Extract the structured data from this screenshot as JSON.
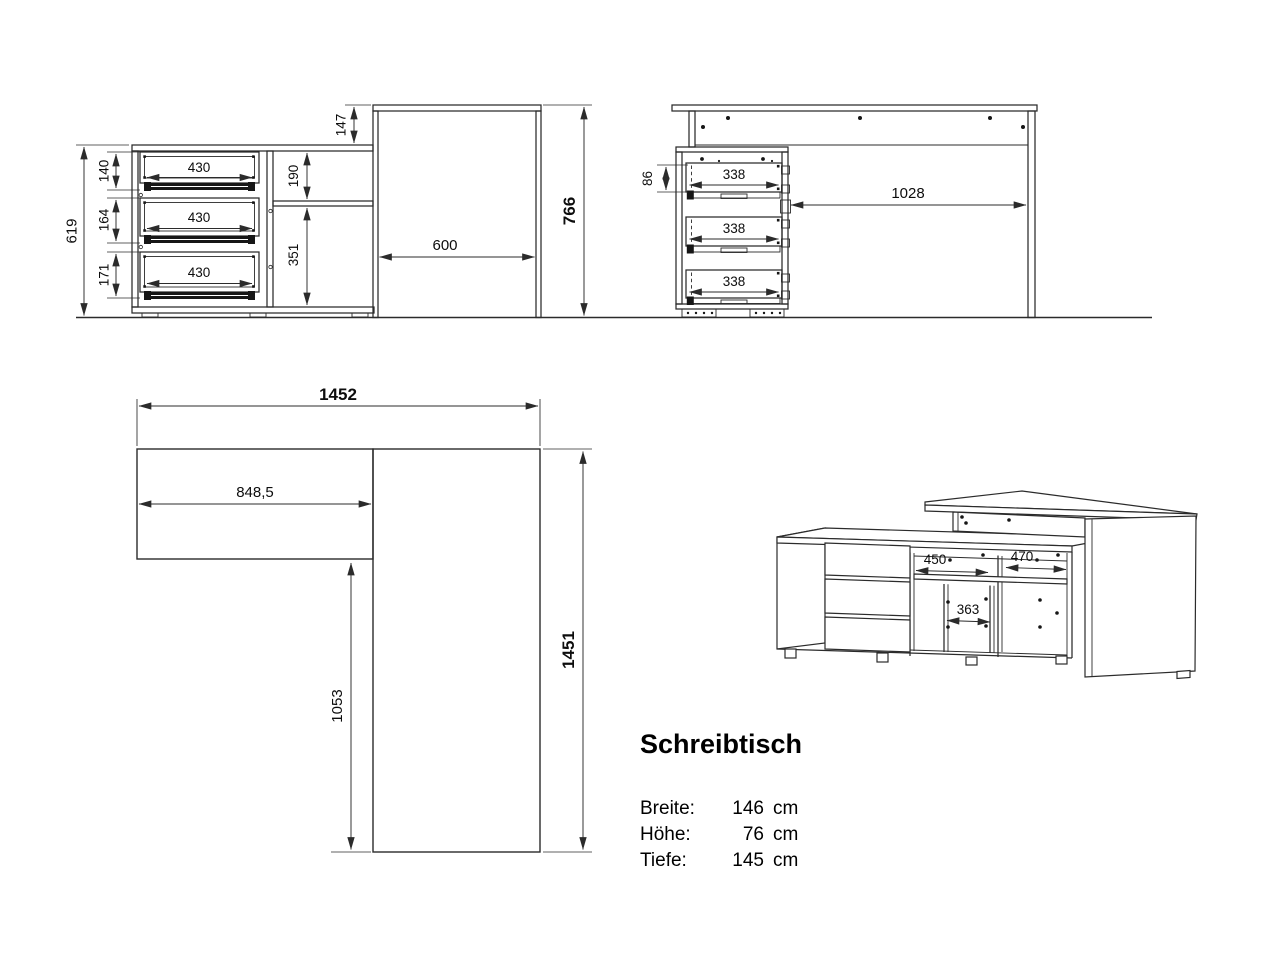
{
  "info": {
    "title": "Schreibtisch",
    "specs": [
      {
        "label": "Breite:",
        "value": "146",
        "unit": "cm"
      },
      {
        "label": "Höhe:",
        "value": "76",
        "unit": "cm"
      },
      {
        "label": "Tiefe:",
        "value": "145",
        "unit": "cm"
      }
    ]
  },
  "views": {
    "front": {
      "dims": {
        "height_total": "766",
        "height_sideboard": "619",
        "drawer1_front": "140",
        "drawer2_front": "164",
        "drawer3_front": "171",
        "drawer_width": "430",
        "niche_upper": "190",
        "niche_lower": "351",
        "top_offset": "147",
        "panel_depth": "600"
      }
    },
    "side": {
      "dims": {
        "drawer_inner": "86",
        "drawer_depth": "338",
        "knee_clearance": "1028"
      }
    },
    "plan": {
      "dims": {
        "width_total": "1452",
        "sideboard_length": "848,5",
        "return_length": "1053",
        "depth_total": "1451"
      }
    },
    "perspective": {
      "dims": {
        "niche_a": "450",
        "niche_b": "470",
        "niche_c": "363"
      }
    }
  },
  "colors": {
    "line": "#2b2b2b",
    "background": "#ffffff"
  }
}
